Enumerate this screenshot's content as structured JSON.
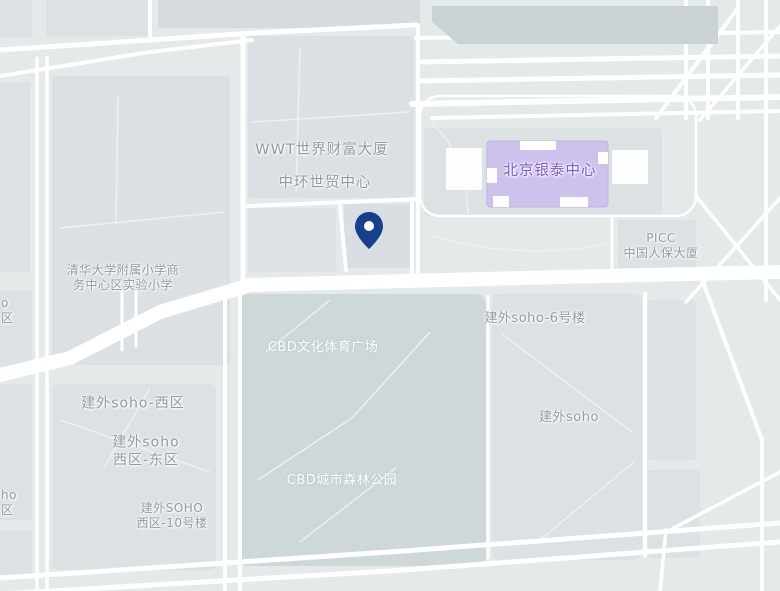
{
  "map": {
    "description": "Street map of Beijing CBD around Jianwai SOHO and Yintai Centre with a dropped location pin",
    "poi_labels": {
      "wwt_tower": "WWT世界财富大厦",
      "central_world_trade": "中环世贸中心",
      "yintai_centre": "北京银泰中心",
      "picc": {
        "line1": "PICC",
        "line2": "中国人保大厦"
      },
      "school": {
        "line1": "清华大学附属小学商",
        "line2": "务中心区实验小学"
      },
      "cbd_culture_sports_plaza": "CBD文化体育广场",
      "jianwai_soho_no6": "建外soho-6号楼",
      "jianwai_soho_west": "建外soho-西区",
      "jianwai_soho_west_east": {
        "line1": "建外soho",
        "line2": "西区-东区"
      },
      "jianwai_soho": "建外soho",
      "cbd_urban_forest_park": "CBD城市森林公园",
      "jianwai_soho_west_no10": {
        "line1": "建外SOHO",
        "line2": "西区-10号楼"
      },
      "clipped_upper": {
        "line1": "o",
        "line2": "区"
      },
      "clipped_lower": {
        "line1": "ho",
        "line2": "区"
      }
    },
    "marker": {
      "type": "location-pin",
      "color": "#163f8c"
    },
    "colors": {
      "background": "#e4e9ea",
      "block": "#dce2e4",
      "block_dark": "#cfd8d8",
      "road": "#ffffff",
      "structure_band": "#cbd2d6",
      "highlight_building_fill": "#cec2ec",
      "highlight_building_text": "#7b5ad2",
      "label_gray": "#939aa0",
      "label_white": "#ffffff"
    }
  }
}
